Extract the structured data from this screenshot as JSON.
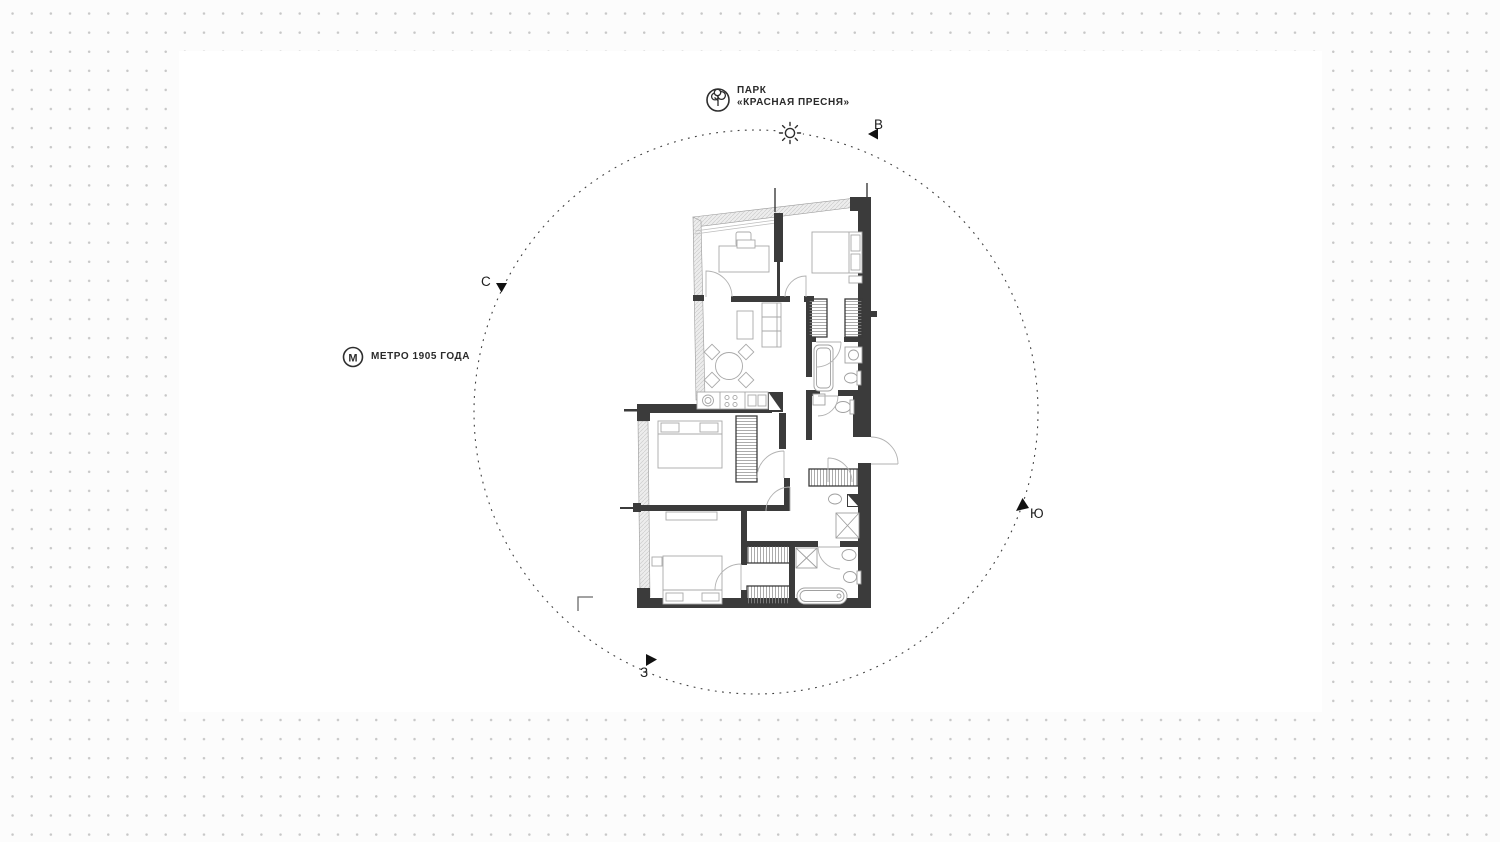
{
  "scene": {
    "type": "apartment-site-plan",
    "surface_color": "#ffffff",
    "dot_grid_color": "#c7c7c7"
  },
  "labels": {
    "park": {
      "line1": "ПАРК",
      "line2": "«КРАСНАЯ ПРЕСНЯ»"
    },
    "metro": {
      "label": "МЕТРО 1905 ГОДА",
      "letter": "М"
    },
    "compass": {
      "north": "С",
      "east": "В",
      "south": "Ю",
      "west": "З"
    }
  },
  "colors": {
    "wall": "#3b3b3b",
    "furniture_line": "#a8a8a8",
    "glazing_fill": "#ededed",
    "marker": "#111111",
    "dashed_circle": "#3f3f3f"
  }
}
